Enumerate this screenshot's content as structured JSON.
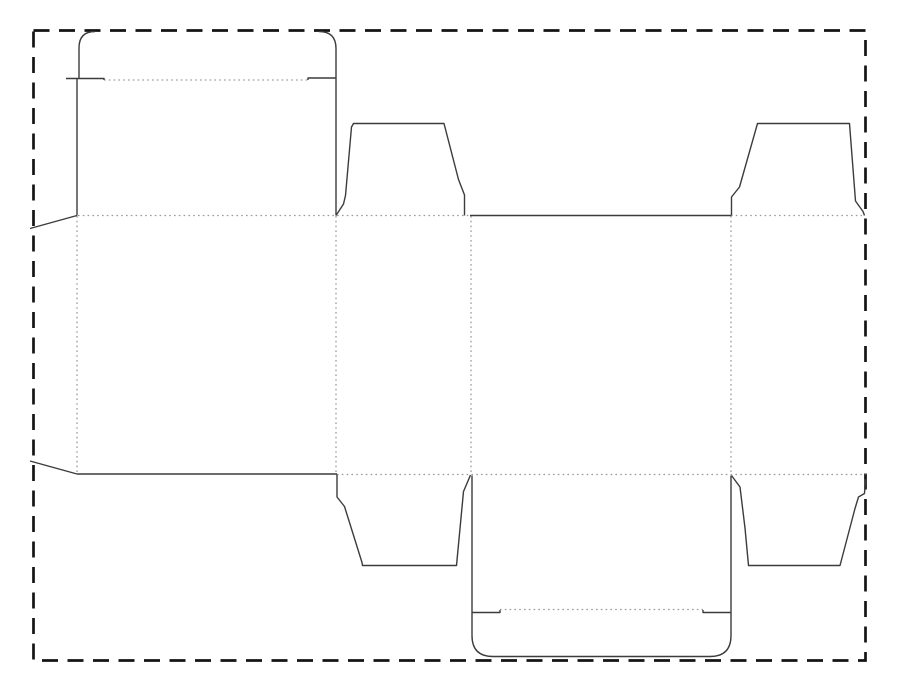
{
  "drawing_title": "carton-dieline",
  "canvas": {
    "width": 900,
    "height": 699,
    "background": "#ffffff"
  },
  "style": {
    "cut_color": "#3c3c3c",
    "cut_width": 1.4,
    "fold_color": "#9b9b9b",
    "fold_width": 1.3,
    "fold_dash": "1.6 3.2",
    "border_color": "#141414",
    "border_width": 2.7,
    "border_dash": "16 9.5"
  },
  "sheet_border": {
    "x": 33.5,
    "y": 30.5,
    "width": 832,
    "height": 630
  },
  "cut_lines": [
    {
      "name": "top-tuck-flap-left-edge",
      "path": "M 79,78.5 L 79,48 Q 79,31.5 95,31.5"
    },
    {
      "name": "top-tuck-flap-notch-left",
      "path": "M 66,78.5 L 104,78.5 L 104,80"
    },
    {
      "name": "top-panel-left-edge",
      "path": "M 77,78.5 L 77,215.5"
    },
    {
      "name": "top-tuck-flap-right-edge",
      "path": "M 319,31.5 Q 336,31.5 336,48.5 L 336,215.5"
    },
    {
      "name": "top-tuck-flap-notch-right",
      "path": "M 308,80 L 308,78 L 336,78"
    },
    {
      "name": "glue-flap-top-diagonal",
      "path": "M 77,215.5 L 30,228.5"
    },
    {
      "name": "glue-flap-bottom-diagonal",
      "path": "M 30,461 L 77,474"
    },
    {
      "name": "back-panel-bottom-edge",
      "path": "M 77,474 L 337,474"
    },
    {
      "name": "dust-flap-top-left-outline",
      "path": "M 336,215.5 L 343.5,204 L 345.5,195.5 L 351.5,127 L 353.5,123.5 L 444,123.5 L 458.5,179.5 L 464.5,195 L 464.5,215.5"
    },
    {
      "name": "front-panel-top-edge",
      "path": "M 470,215.5 L 731,215.5"
    },
    {
      "name": "dust-flap-top-right-outline",
      "path": "M 731.5,215.5 L 731.5,197 L 739.5,187 L 757.5,123.5 L 849.5,123.5 L 855.5,201 L 863,211.5 L 864.5,215.5"
    },
    {
      "name": "dust-flap-bottom-left-outline",
      "path": "M 337,474.5 L 337,497 L 344.5,506.5 L 362,562.5 L 362.5,565.5 L 456.5,565.5 L 463.5,491.5 L 470.5,475"
    },
    {
      "name": "bottom-closure-flap-outline",
      "path": "M 472,475.5 L 472,635.5 Q 472,656.5 493,656.5 L 710,656.5 Q 731,656.5 731,635.5 L 731,475.5"
    },
    {
      "name": "bottom-flap-notch-left",
      "path": "M 472,612.5 L 500,612.5 L 500,610"
    },
    {
      "name": "bottom-flap-notch-right",
      "path": "M 703,610 L 703,612.5 L 731,612.5"
    },
    {
      "name": "dust-flap-bottom-right-outline",
      "path": "M 731.5,475.5 L 740,487 L 745,528 L 748.5,565.5 L 840,565.5 L 855,508.5 L 858.5,497 L 864.5,493.5 L 865.5,479"
    }
  ],
  "fold_lines": [
    {
      "name": "fold-top-tuck",
      "x1": 104,
      "y1": 80,
      "x2": 308,
      "y2": 80
    },
    {
      "name": "fold-top-main-left",
      "x1": 78,
      "y1": 215.5,
      "x2": 470,
      "y2": 215.5
    },
    {
      "name": "fold-top-main-right",
      "x1": 731,
      "y1": 215.5,
      "x2": 862,
      "y2": 215.5
    },
    {
      "name": "fold-bottom-main",
      "x1": 337,
      "y1": 474.5,
      "x2": 865.5,
      "y2": 474.5
    },
    {
      "name": "fold-bottom-tuck",
      "x1": 500,
      "y1": 609.5,
      "x2": 703,
      "y2": 609.5
    },
    {
      "name": "fold-vertical-glue-flap",
      "x1": 77,
      "y1": 216,
      "x2": 77,
      "y2": 474
    },
    {
      "name": "fold-vertical-panel-2-3",
      "x1": 336,
      "y1": 216,
      "x2": 336,
      "y2": 474
    },
    {
      "name": "fold-vertical-panel-3-4",
      "x1": 471,
      "y1": 216,
      "x2": 471,
      "y2": 474
    },
    {
      "name": "fold-vertical-panel-4-5",
      "x1": 731,
      "y1": 216,
      "x2": 731,
      "y2": 474
    }
  ]
}
